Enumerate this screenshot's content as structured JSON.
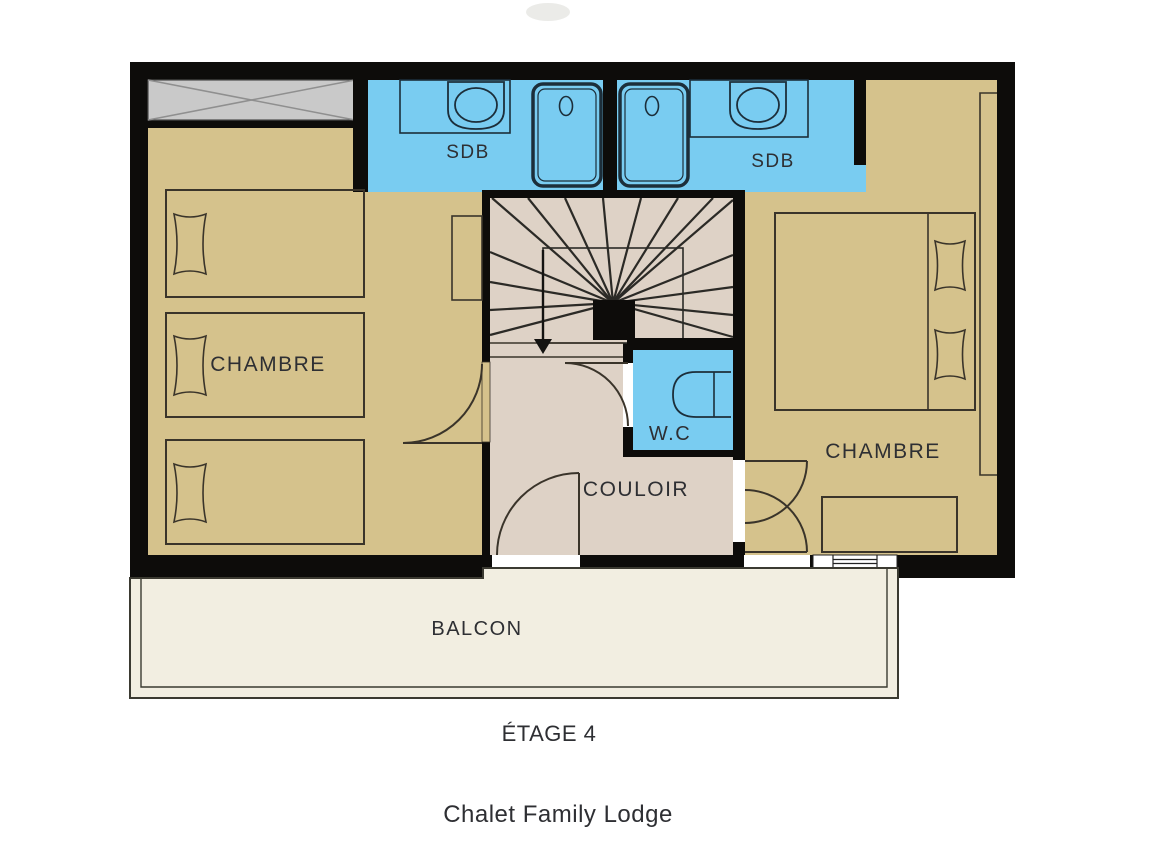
{
  "plan": {
    "floor_label": "ÉTAGE 4",
    "title": "Chalet Family Lodge",
    "rooms": {
      "bedroom_left": "CHAMBRE",
      "bedroom_right": "CHAMBRE",
      "bathroom_left": "SDB",
      "bathroom_right": "SDB",
      "wc": "W.C",
      "corridor": "COULOIR",
      "balcony": "BALCON"
    }
  },
  "colors": {
    "bg": "#ffffff",
    "wall": "#0d0c0a",
    "room": "#d5c28c",
    "wet": "#79ccf1",
    "hall": "#ded2c6",
    "balcony": "#f2eee1",
    "hatch": "#c9c9c9",
    "line": "#3a342a",
    "fixture": "#1c2e3a",
    "label": "#2e2f33"
  }
}
